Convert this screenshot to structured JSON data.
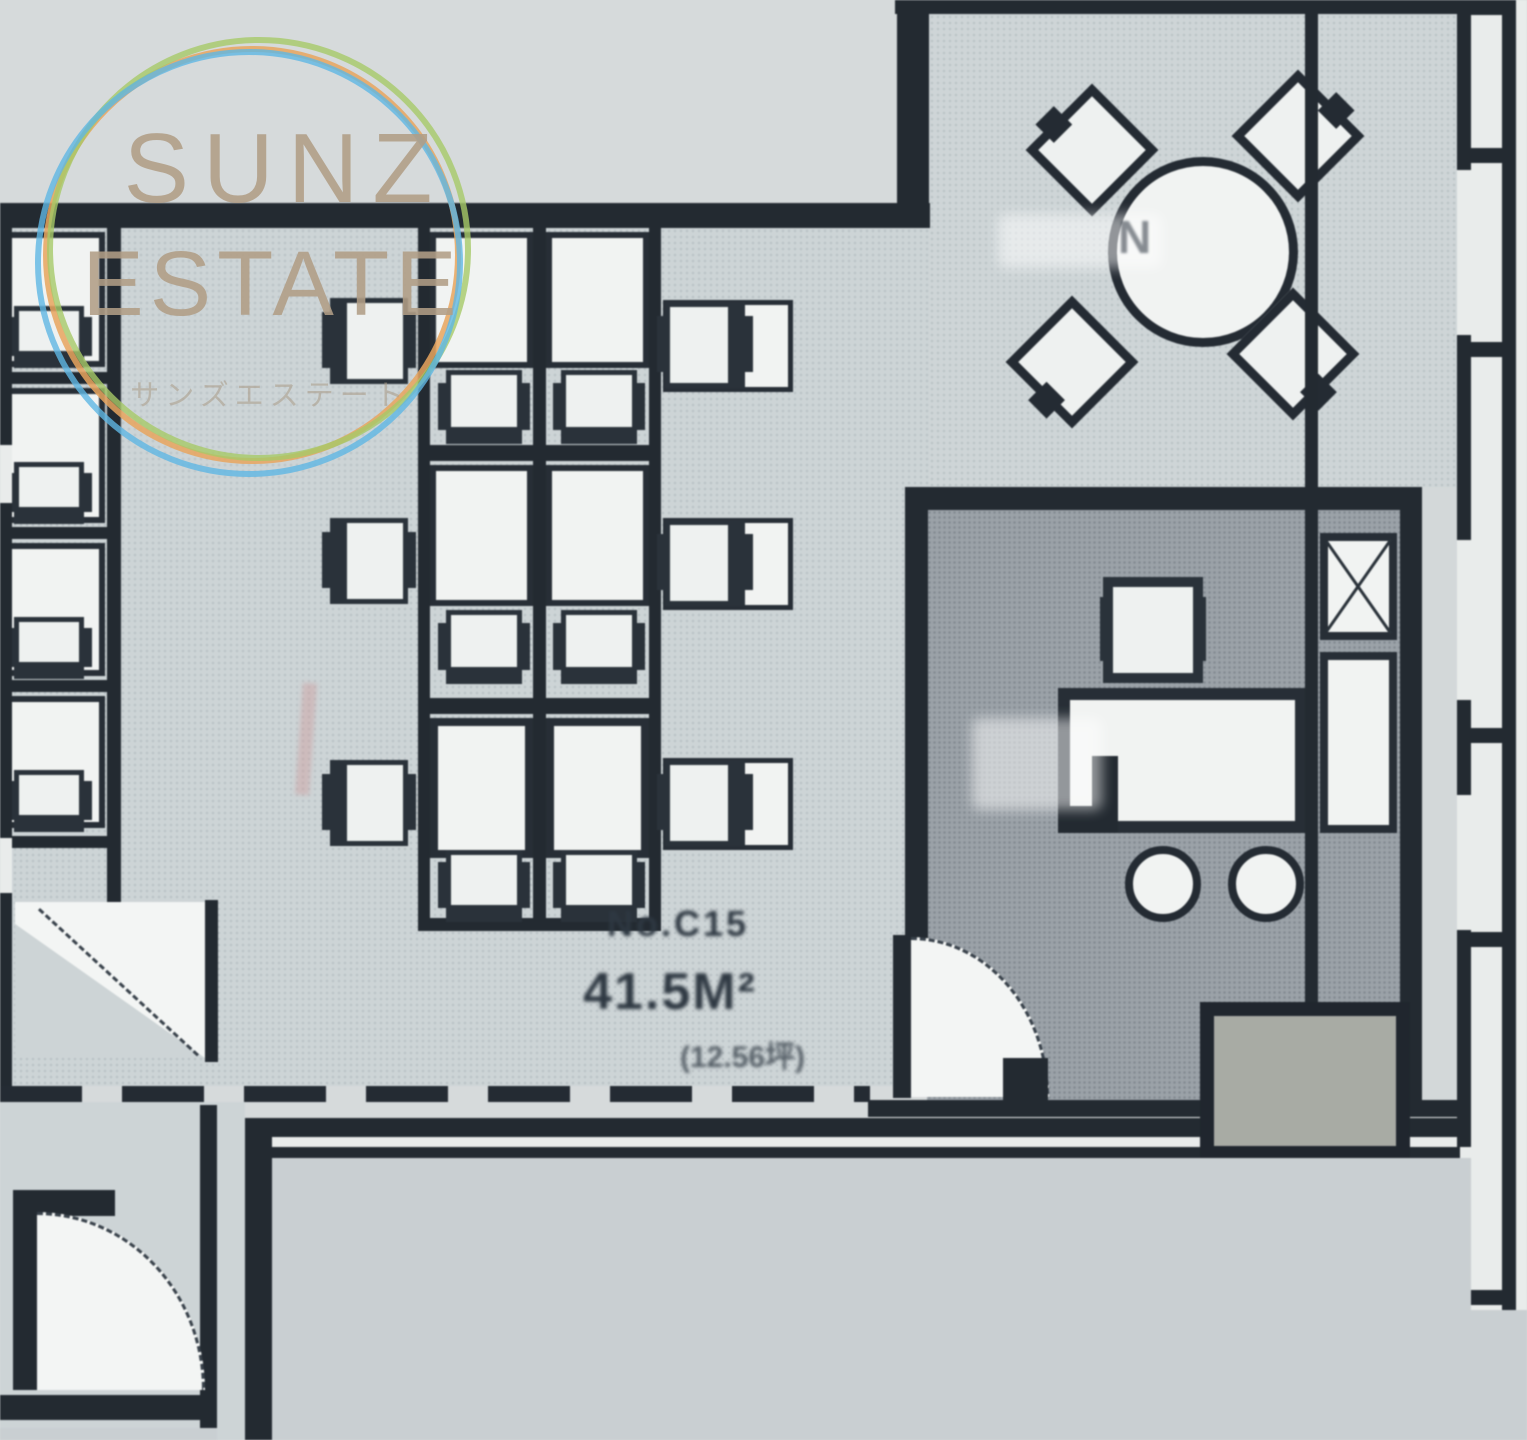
{
  "watermark": {
    "title": "SUNZ",
    "subtitle": "ESTATE",
    "caption": "サンズエステート"
  },
  "area_label": {
    "line1": "No.C15",
    "line2": "41.5M²",
    "line3": "(12.56坪)"
  },
  "meeting_table": {
    "mark": "N"
  },
  "colors": {
    "wall": "#232a31",
    "office_floor": "#cdd4d6",
    "meeting_floor": "#ced5d7",
    "inner_room_floor": "#9ba2a8",
    "lower_area": "#c9cfd2",
    "shaft": "#a8aba4",
    "furniture_fill": "#f1f3f2",
    "ring_orange": "#e8a55e",
    "ring_green": "#a6c968",
    "ring_blue": "#5fb6e3",
    "brand": "#b19d85"
  }
}
